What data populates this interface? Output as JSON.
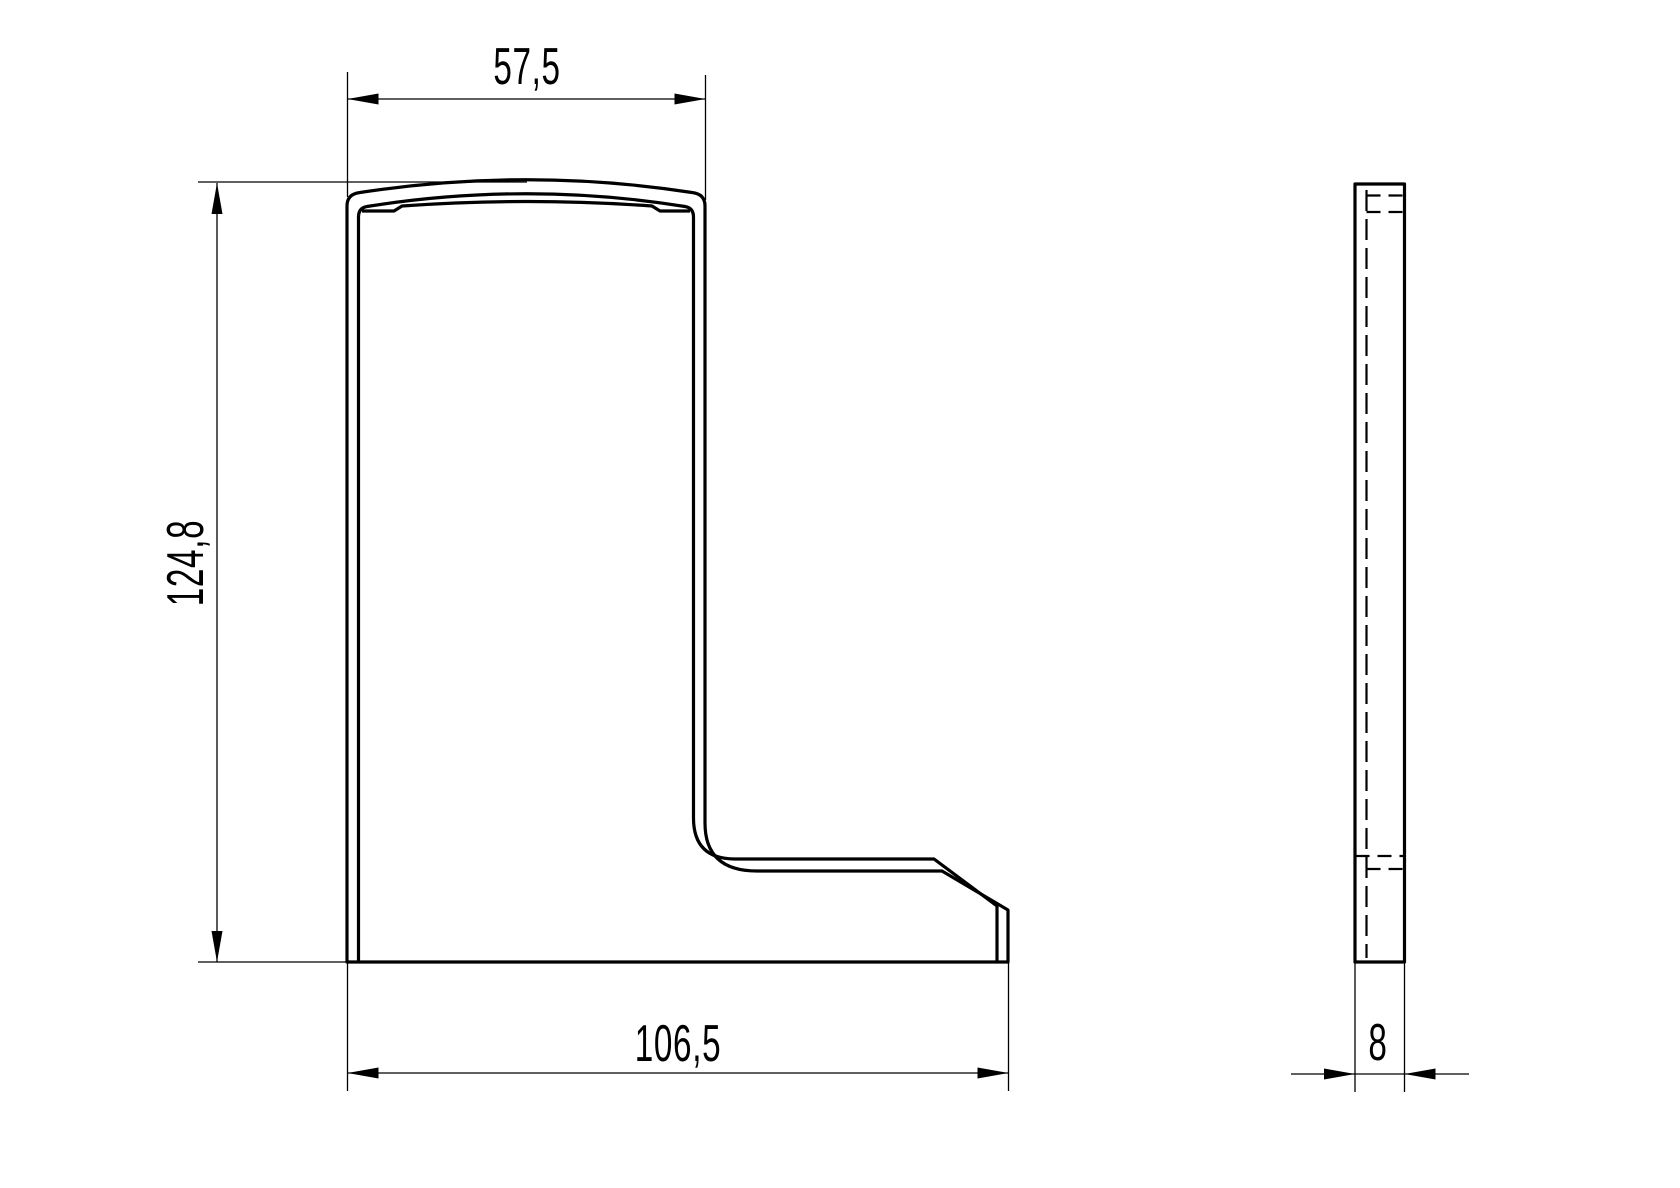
{
  "dimensions": {
    "top_width": "57,5",
    "height": "124,8",
    "base_width": "106,5",
    "thickness": "8"
  },
  "style": {
    "line_color": "#000000",
    "background_color": "#ffffff"
  }
}
